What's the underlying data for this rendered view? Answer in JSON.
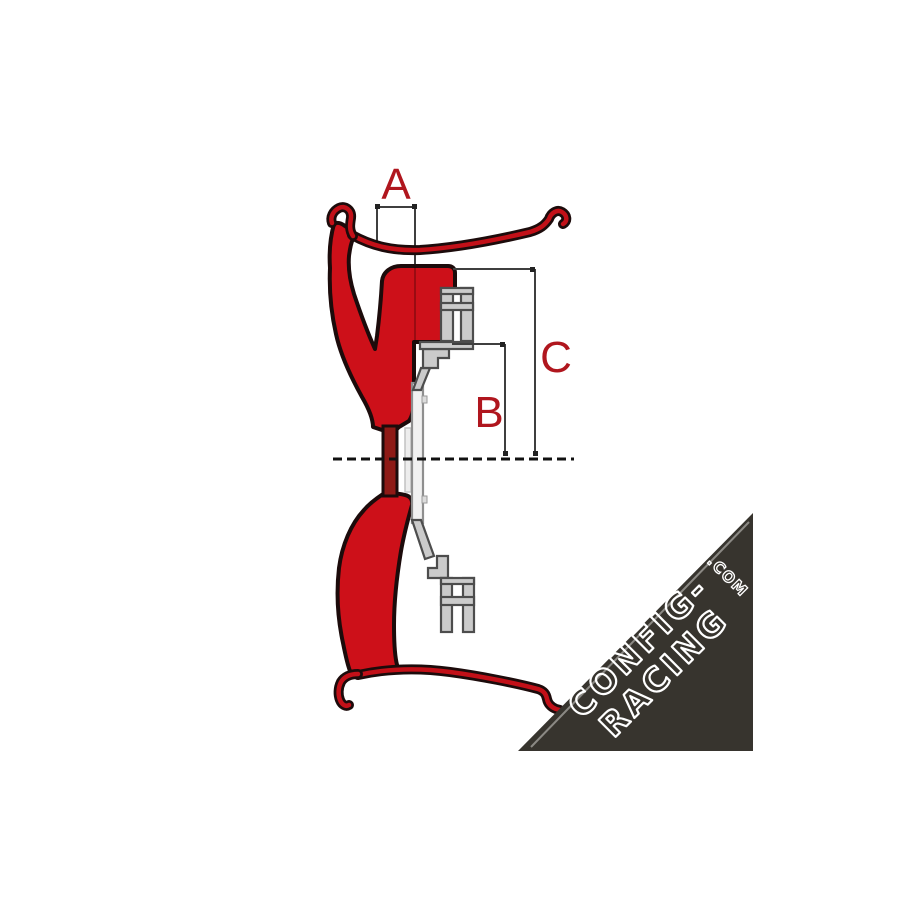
{
  "figure": {
    "description": "Wheel rim cross-section technical diagram with offset dimensions",
    "dimension_labels": {
      "a": "A",
      "b": "B",
      "c": "C"
    },
    "colors": {
      "background": "#ffffff",
      "rim_red": "#cd1019",
      "neck_dark_red": "#8e1a16",
      "outline_black": "#1c0b0b",
      "hub_gray": "#cbcbcb",
      "hub_gray_light": "#ededed",
      "hub_outline": "#4d4d4d",
      "dimension_line": "#3f3f3f",
      "label_red": "#b0161e",
      "centerline_black": "#111111",
      "watermark_bg": "#37342e",
      "watermark_edge": "#8b8984",
      "watermark_text": "#ffffff"
    }
  },
  "watermark": {
    "line1": "CONFIG-",
    "line2": "RACING",
    "suffix": ".COM"
  }
}
